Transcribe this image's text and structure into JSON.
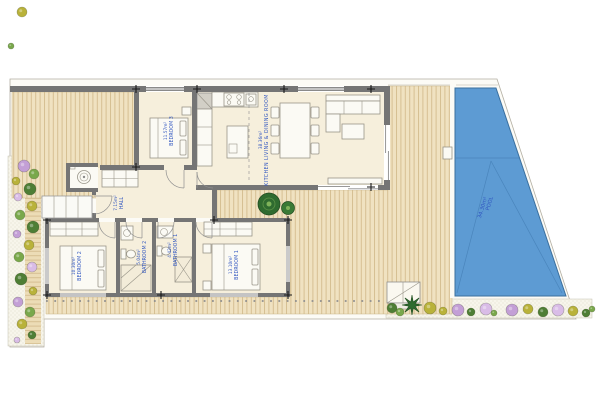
{
  "plan": {
    "rooms": [
      {
        "id": "bedroom-3",
        "name": "BEDROOM 3",
        "area": "11.57m²"
      },
      {
        "id": "kitchen-living-dining",
        "name": "KITCHEN LIVING & DINING ROOM",
        "area": "38.36m²"
      },
      {
        "id": "hall",
        "name": "HALL",
        "area": "7.15m²"
      },
      {
        "id": "bedroom-2",
        "name": "BEDROOM 2",
        "area": "10.30m²"
      },
      {
        "id": "bathroom-2",
        "name": "BATHROOM 2",
        "area": "5.04m²"
      },
      {
        "id": "bathroom-1",
        "name": "BATHROOM 1",
        "area": "4.42m²"
      },
      {
        "id": "bedroom-1",
        "name": "BEDROOM 1",
        "area": "13.10m²"
      },
      {
        "id": "pool",
        "name": "POOL",
        "area": "34.30m²"
      }
    ],
    "colors": {
      "label_text": "#2f55c0",
      "wall": "#757575",
      "room_floor": "#f6efdc",
      "deck": "#f0e2c1",
      "deck_stripe": "#d6bf92",
      "pool_water": "#5d9bd3",
      "pool_line": "#4a85bc",
      "plot_bg": "#fcfbf6",
      "plants": [
        "#4e7e35",
        "#79a84b",
        "#b9b23a",
        "#c39fd6",
        "#d9bce7",
        "#2f6b2f"
      ]
    },
    "icons": {
      "washing_machine": "washing-machine-icon",
      "cooktop": "cooktop-icon",
      "sink": "sink-icon",
      "toilet": "toilet-icon",
      "shower": "shower-icon",
      "plant": "plant-icon",
      "palm": "palm-icon"
    }
  }
}
